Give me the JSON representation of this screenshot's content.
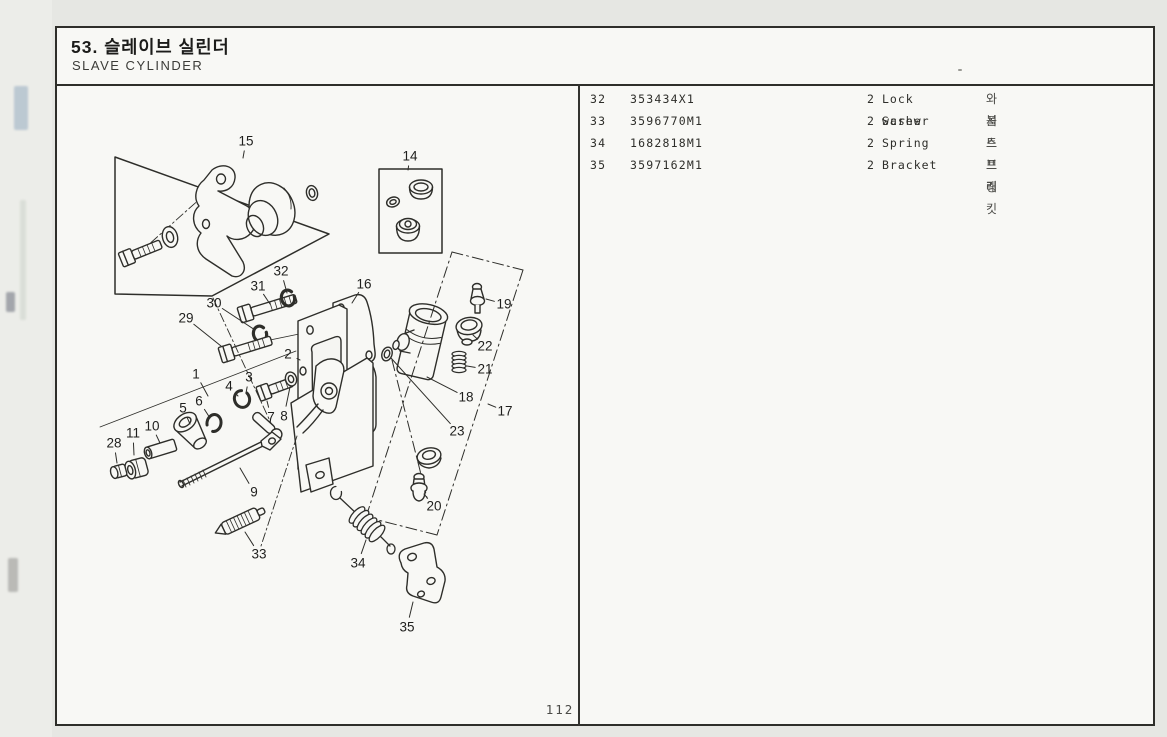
{
  "page": {
    "colors": {
      "paper": "#f8f8f5",
      "ink": "#2e2e2a",
      "background": "#e6e7e3"
    },
    "page_number": "112"
  },
  "header": {
    "title_kr": "53. 슬레이브 실린더",
    "title_en": "SLAVE CYLINDER"
  },
  "parts_table": {
    "rows": [
      {
        "ref": "32",
        "part_no": "353434X1",
        "qty": "2",
        "name": "Lock washer",
        "name_kr": "와 셔"
      },
      {
        "ref": "33",
        "part_no": "3596770M1",
        "qty": "2",
        "name": "Screw",
        "name_kr": "볼 트"
      },
      {
        "ref": "34",
        "part_no": "1682818M1",
        "qty": "2",
        "name": "Spring",
        "name_kr": "스프링"
      },
      {
        "ref": "35",
        "part_no": "3597162M1",
        "qty": "2",
        "name": "Bracket",
        "name_kr": "브래킷"
      }
    ]
  },
  "diagram": {
    "description": "exploded view of slave cylinder assembly",
    "labels": [
      {
        "t": "15",
        "x": 246,
        "y": 141,
        "lx": 243,
        "ly": 158
      },
      {
        "t": "14",
        "x": 410,
        "y": 156,
        "lx": 408,
        "ly": 170
      },
      {
        "t": "32",
        "x": 281,
        "y": 271,
        "lx": 287,
        "ly": 293
      },
      {
        "t": "31",
        "x": 258,
        "y": 286,
        "lx": 270,
        "ly": 304
      },
      {
        "t": "30",
        "x": 214,
        "y": 303,
        "lx": 255,
        "ly": 330
      },
      {
        "t": "29",
        "x": 186,
        "y": 318,
        "lx": 221,
        "ly": 346
      },
      {
        "t": "16",
        "x": 364,
        "y": 284,
        "lx": 352,
        "ly": 303
      },
      {
        "t": "2",
        "x": 288,
        "y": 354,
        "lx": 300,
        "ly": 360
      },
      {
        "t": "1",
        "x": 196,
        "y": 374,
        "lx": 208,
        "ly": 396
      },
      {
        "t": "3",
        "x": 249,
        "y": 377,
        "lx": 246,
        "ly": 393
      },
      {
        "t": "4",
        "x": 229,
        "y": 386,
        "lx": 238,
        "ly": 396
      },
      {
        "t": "5",
        "x": 183,
        "y": 408,
        "lx": 190,
        "ly": 424
      },
      {
        "t": "6",
        "x": 199,
        "y": 401,
        "lx": 210,
        "ly": 418
      },
      {
        "t": "7",
        "x": 271,
        "y": 417,
        "lx": 267,
        "ly": 401
      },
      {
        "t": "8",
        "x": 284,
        "y": 416,
        "lx": 290,
        "ly": 387
      },
      {
        "t": "10",
        "x": 152,
        "y": 426,
        "lx": 160,
        "ly": 443
      },
      {
        "t": "11",
        "x": 133,
        "y": 433,
        "lx": 134,
        "ly": 455
      },
      {
        "t": "28",
        "x": 114,
        "y": 443,
        "lx": 117,
        "ly": 463
      },
      {
        "t": "9",
        "x": 254,
        "y": 492,
        "lx": 240,
        "ly": 468
      },
      {
        "t": "33",
        "x": 259,
        "y": 554,
        "lx": 245,
        "ly": 532
      },
      {
        "t": "34",
        "x": 358,
        "y": 563,
        "lx": 366,
        "ly": 540
      },
      {
        "t": "35",
        "x": 407,
        "y": 627,
        "lx": 413,
        "ly": 602
      },
      {
        "t": "20",
        "x": 434,
        "y": 506,
        "lx": 424,
        "ly": 494
      },
      {
        "t": "23",
        "x": 457,
        "y": 431,
        "lx": 391,
        "ly": 358
      },
      {
        "t": "18",
        "x": 466,
        "y": 397,
        "lx": 427,
        "ly": 377
      },
      {
        "t": "17",
        "x": 505,
        "y": 411,
        "lx": 488,
        "ly": 404
      },
      {
        "t": "19",
        "x": 504,
        "y": 304,
        "lx": 486,
        "ly": 299
      },
      {
        "t": "22",
        "x": 485,
        "y": 346,
        "lx": 473,
        "ly": 335
      },
      {
        "t": "21",
        "x": 485,
        "y": 369,
        "lx": 467,
        "ly": 366
      }
    ]
  }
}
